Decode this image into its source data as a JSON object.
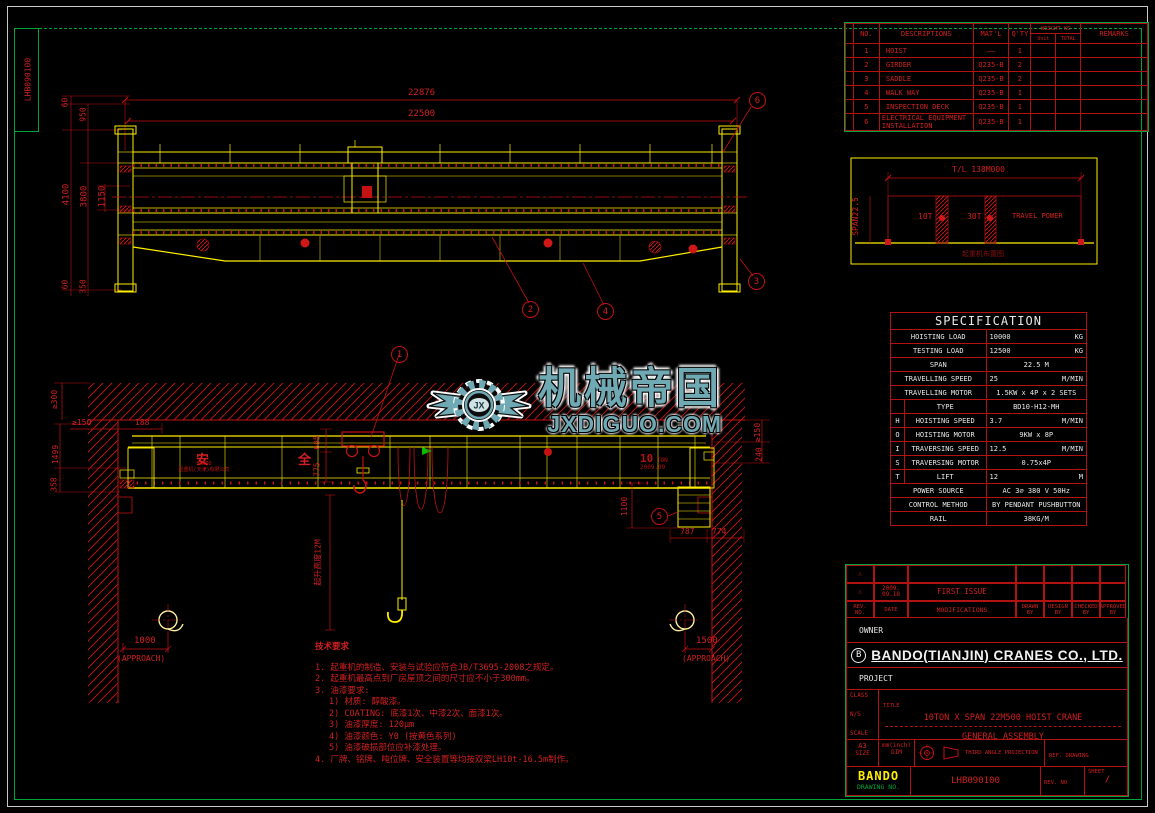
{
  "frame": {
    "sheet_no_vertical": "LHB090100"
  },
  "watermark": {
    "logo_text": "JX",
    "brand_cn": "机械帝国",
    "brand_url": "JXDIGUO.COM",
    "color": "#6fa9b4"
  },
  "parts_table": {
    "col_no": "NO.",
    "col_desc": "DESCRIPTIONS",
    "col_matl": "MAT'L",
    "col_qty": "Q'TY",
    "col_weight": "WEIGHT KG",
    "col_unit": "Unit",
    "col_total": "TOTAL",
    "col_remarks": "REMARKS",
    "rows": [
      {
        "no": "1",
        "desc": "HOIST",
        "matl": "——",
        "qty": "1",
        "unit": "",
        "total": "",
        "remarks": ""
      },
      {
        "no": "2",
        "desc": "GIRDER",
        "matl": "Q235-B",
        "qty": "2",
        "unit": "",
        "total": "",
        "remarks": ""
      },
      {
        "no": "3",
        "desc": "SADDLE",
        "matl": "Q235-B",
        "qty": "2",
        "unit": "",
        "total": "",
        "remarks": ""
      },
      {
        "no": "4",
        "desc": "WALK WAY",
        "matl": "Q235-B",
        "qty": "1",
        "unit": "",
        "total": "",
        "remarks": ""
      },
      {
        "no": "5",
        "desc": "INSPECTION DECK",
        "matl": "Q235-B",
        "qty": "1",
        "unit": "",
        "total": "",
        "remarks": ""
      },
      {
        "no": "6",
        "desc": "ELECTRICAL EQUIPMENT INSTALLATION",
        "matl": "Q235-B",
        "qty": "1",
        "unit": "",
        "total": "",
        "remarks": ""
      }
    ]
  },
  "rail_layout": {
    "total_length": "T/L 138M000",
    "span": "SPAN22.5",
    "crane1": "10T",
    "crane2": "30T",
    "crane3": "TRAVEL POWER",
    "caption": "起重机布置图"
  },
  "specification": {
    "title": "SPECIFICATION",
    "rows": [
      {
        "g": "",
        "label": "HOISTING LOAD",
        "value": "10000",
        "unit": "KG"
      },
      {
        "g": "",
        "label": "TESTING LOAD",
        "value": "12500",
        "unit": "KG"
      },
      {
        "g": "",
        "label": "SPAN",
        "value": "22.5 M",
        "unit": ""
      },
      {
        "g": "",
        "label": "TRAVELLING SPEED",
        "value": "25",
        "unit": "M/MIN"
      },
      {
        "g": "",
        "label": "TRAVELLING MOTOR",
        "value": "1.5KW x 4P x 2 SETS",
        "unit": ""
      },
      {
        "g": "",
        "label": "TYPE",
        "value": "BD10-H12-MH",
        "unit": ""
      },
      {
        "g": "H",
        "label": "HOISTING SPEED",
        "value": "3.7",
        "unit": "M/MIN"
      },
      {
        "g": "O",
        "label": "HOISTING MOTOR",
        "value": "9KW x 8P",
        "unit": ""
      },
      {
        "g": "I",
        "label": "TRAVERSING SPEED",
        "value": "12.5",
        "unit": "M/MIN"
      },
      {
        "g": "S",
        "label": "TRAVERSING MOTOR",
        "value": "0.75x4P",
        "unit": ""
      },
      {
        "g": "T",
        "label": "LIFT",
        "value": "12",
        "unit": "M"
      },
      {
        "g": "",
        "label": "POWER SOURCE",
        "value": "AC 3∅  380 V 50Hz",
        "unit": ""
      },
      {
        "g": "",
        "label": "CONTROL METHOD",
        "value": "BY PENDANT PUSHBUTTON",
        "unit": ""
      },
      {
        "g": "",
        "label": "RAIL",
        "value": "38KG/M",
        "unit": ""
      }
    ]
  },
  "revision": {
    "r1_date": "2009. 09.18",
    "r1_text": "FIRST ISSUE",
    "h_rev": "REV. NO.",
    "h_date": "DATE",
    "h_mod": "MODIFICATIONS",
    "h_drawn": "DRAWN BY",
    "h_design": "DESIGN BY",
    "h_checked": "CHECKED BY",
    "h_approved": "APPROVED BY"
  },
  "title_block": {
    "owner": "OWNER",
    "company": "BANDO(TIANJIN) CRANES CO., LTD.",
    "logo_letter": "B",
    "project": "PROJECT",
    "class": "CLASS",
    "ns": "N/S",
    "scale": "SCALE",
    "title_label": "TITLE",
    "title1": "10TON X SPAN 22M500 HOIST CRANE",
    "title2": "GENERAL ASSEMBLY",
    "size_v": "A3",
    "size_l": "SIZE",
    "dim_v": "mm(inch)",
    "dim_l": "DIM",
    "projection": "THIRD ANGLE PROJECTION",
    "ref": "REF. DRAWING",
    "brand": "BANDO",
    "dno_label": "DRAWING NO.",
    "dno": "LHB090100",
    "rev_no": "REV. NO",
    "sheet": "SHEET",
    "sheet_value": "/"
  },
  "notes": {
    "title": "技术要求",
    "l1": "1. 起重机的制造、安装与试验应符合JB/T3695-2008之规定。",
    "l2": "2. 起重机最高点到厂房屋顶之间的尺寸应不小于300mm。",
    "l3": "3. 油漆要求:",
    "l3a": "1) 材质: 醇酸漆。",
    "l3b": "2) COATING: 底漆1次、中漆2次、面漆1次。",
    "l3c": "3) 油漆厚度: 120μm",
    "l3d": "4) 油漆颜色: Y0 (按黄色系列)",
    "l3e": "5) 油漆破损部位应补漆处理。",
    "l4": "4. 厂牌、铭牌、吨位牌、安全装置等均按双梁LH10t-16.5m制作。"
  },
  "plan_view": {
    "dim_total": "22876",
    "dim_span": "22500",
    "dim_60t": "60",
    "dim_950": "950",
    "dim_4100": "4100",
    "dim_3800": "3800",
    "dim_1150": "1150",
    "dim_60b": "60",
    "dim_350": "350",
    "balloon_2": "2",
    "balloon_3": "3",
    "balloon_4": "4",
    "balloon_6": "6"
  },
  "elevation_view": {
    "balloon_1": "1",
    "balloon_5": "5",
    "dim_c300": "≥300",
    "dim_c150l": "≥150",
    "dim_188": "188",
    "dim_1499": "1499",
    "dim_358": "358",
    "dim_695": "695",
    "dim_775": "775",
    "dim_c150r": "≥150",
    "dim_240": "240",
    "dim_1100": "1100",
    "dim_787": "787",
    "dim_774": "774",
    "approach_l": "1000",
    "approach_l_label": "(APPROACH)",
    "approach_r": "1500",
    "approach_r_label": "(APPROACH)",
    "lift_height": "起升高度12M",
    "safety1": "安",
    "safety2": "全",
    "girder_brand": "BANDO",
    "girder_brand2": "起重机(天津)有限公司",
    "cap1": "10",
    "cap2": "TON",
    "cap3": "2009.09"
  },
  "colors": {
    "red": "#c41212",
    "yellow": "#ffee00",
    "green": "#00a33c",
    "white": "#e8e8e8",
    "teal": "#6fa9b4"
  }
}
